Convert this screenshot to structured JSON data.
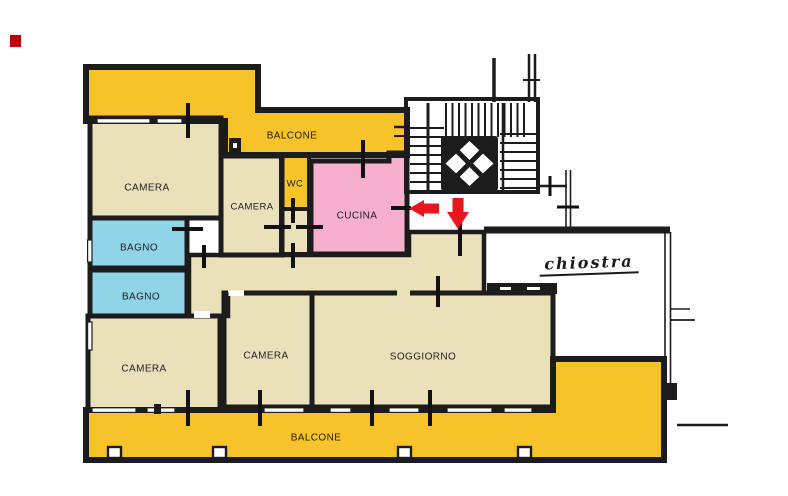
{
  "title": "apartment-floor-plan",
  "labels": {
    "balcone_top": "BALCONE",
    "camera_top_left": "CAMERA",
    "camera_top_middle": "CAMERA",
    "wc": "WC",
    "cucina": "CUCINA",
    "bagno_upper": "BAGNO",
    "bagno_lower": "BAGNO",
    "camera_bottom_left": "CAMERA",
    "camera_bottom_middle": "CAMERA",
    "soggiorno": "SOGGIORNO",
    "balcone_bottom": "BALCONE",
    "chiostra": "chiostra"
  },
  "annotations": {
    "arrow_left": "red-arrow-left",
    "arrow_down": "red-arrow-down",
    "marker": "red-square-marker"
  },
  "colors": {
    "balcony_yellow": "#F7C32B",
    "room_beige": "#EAE1BA",
    "bath_blue": "#90D4E8",
    "kitchen_pink": "#F6AFCD",
    "arrow_red": "#E8161D",
    "marker_red": "#C00000",
    "wall_black": "#1C1C1C"
  }
}
